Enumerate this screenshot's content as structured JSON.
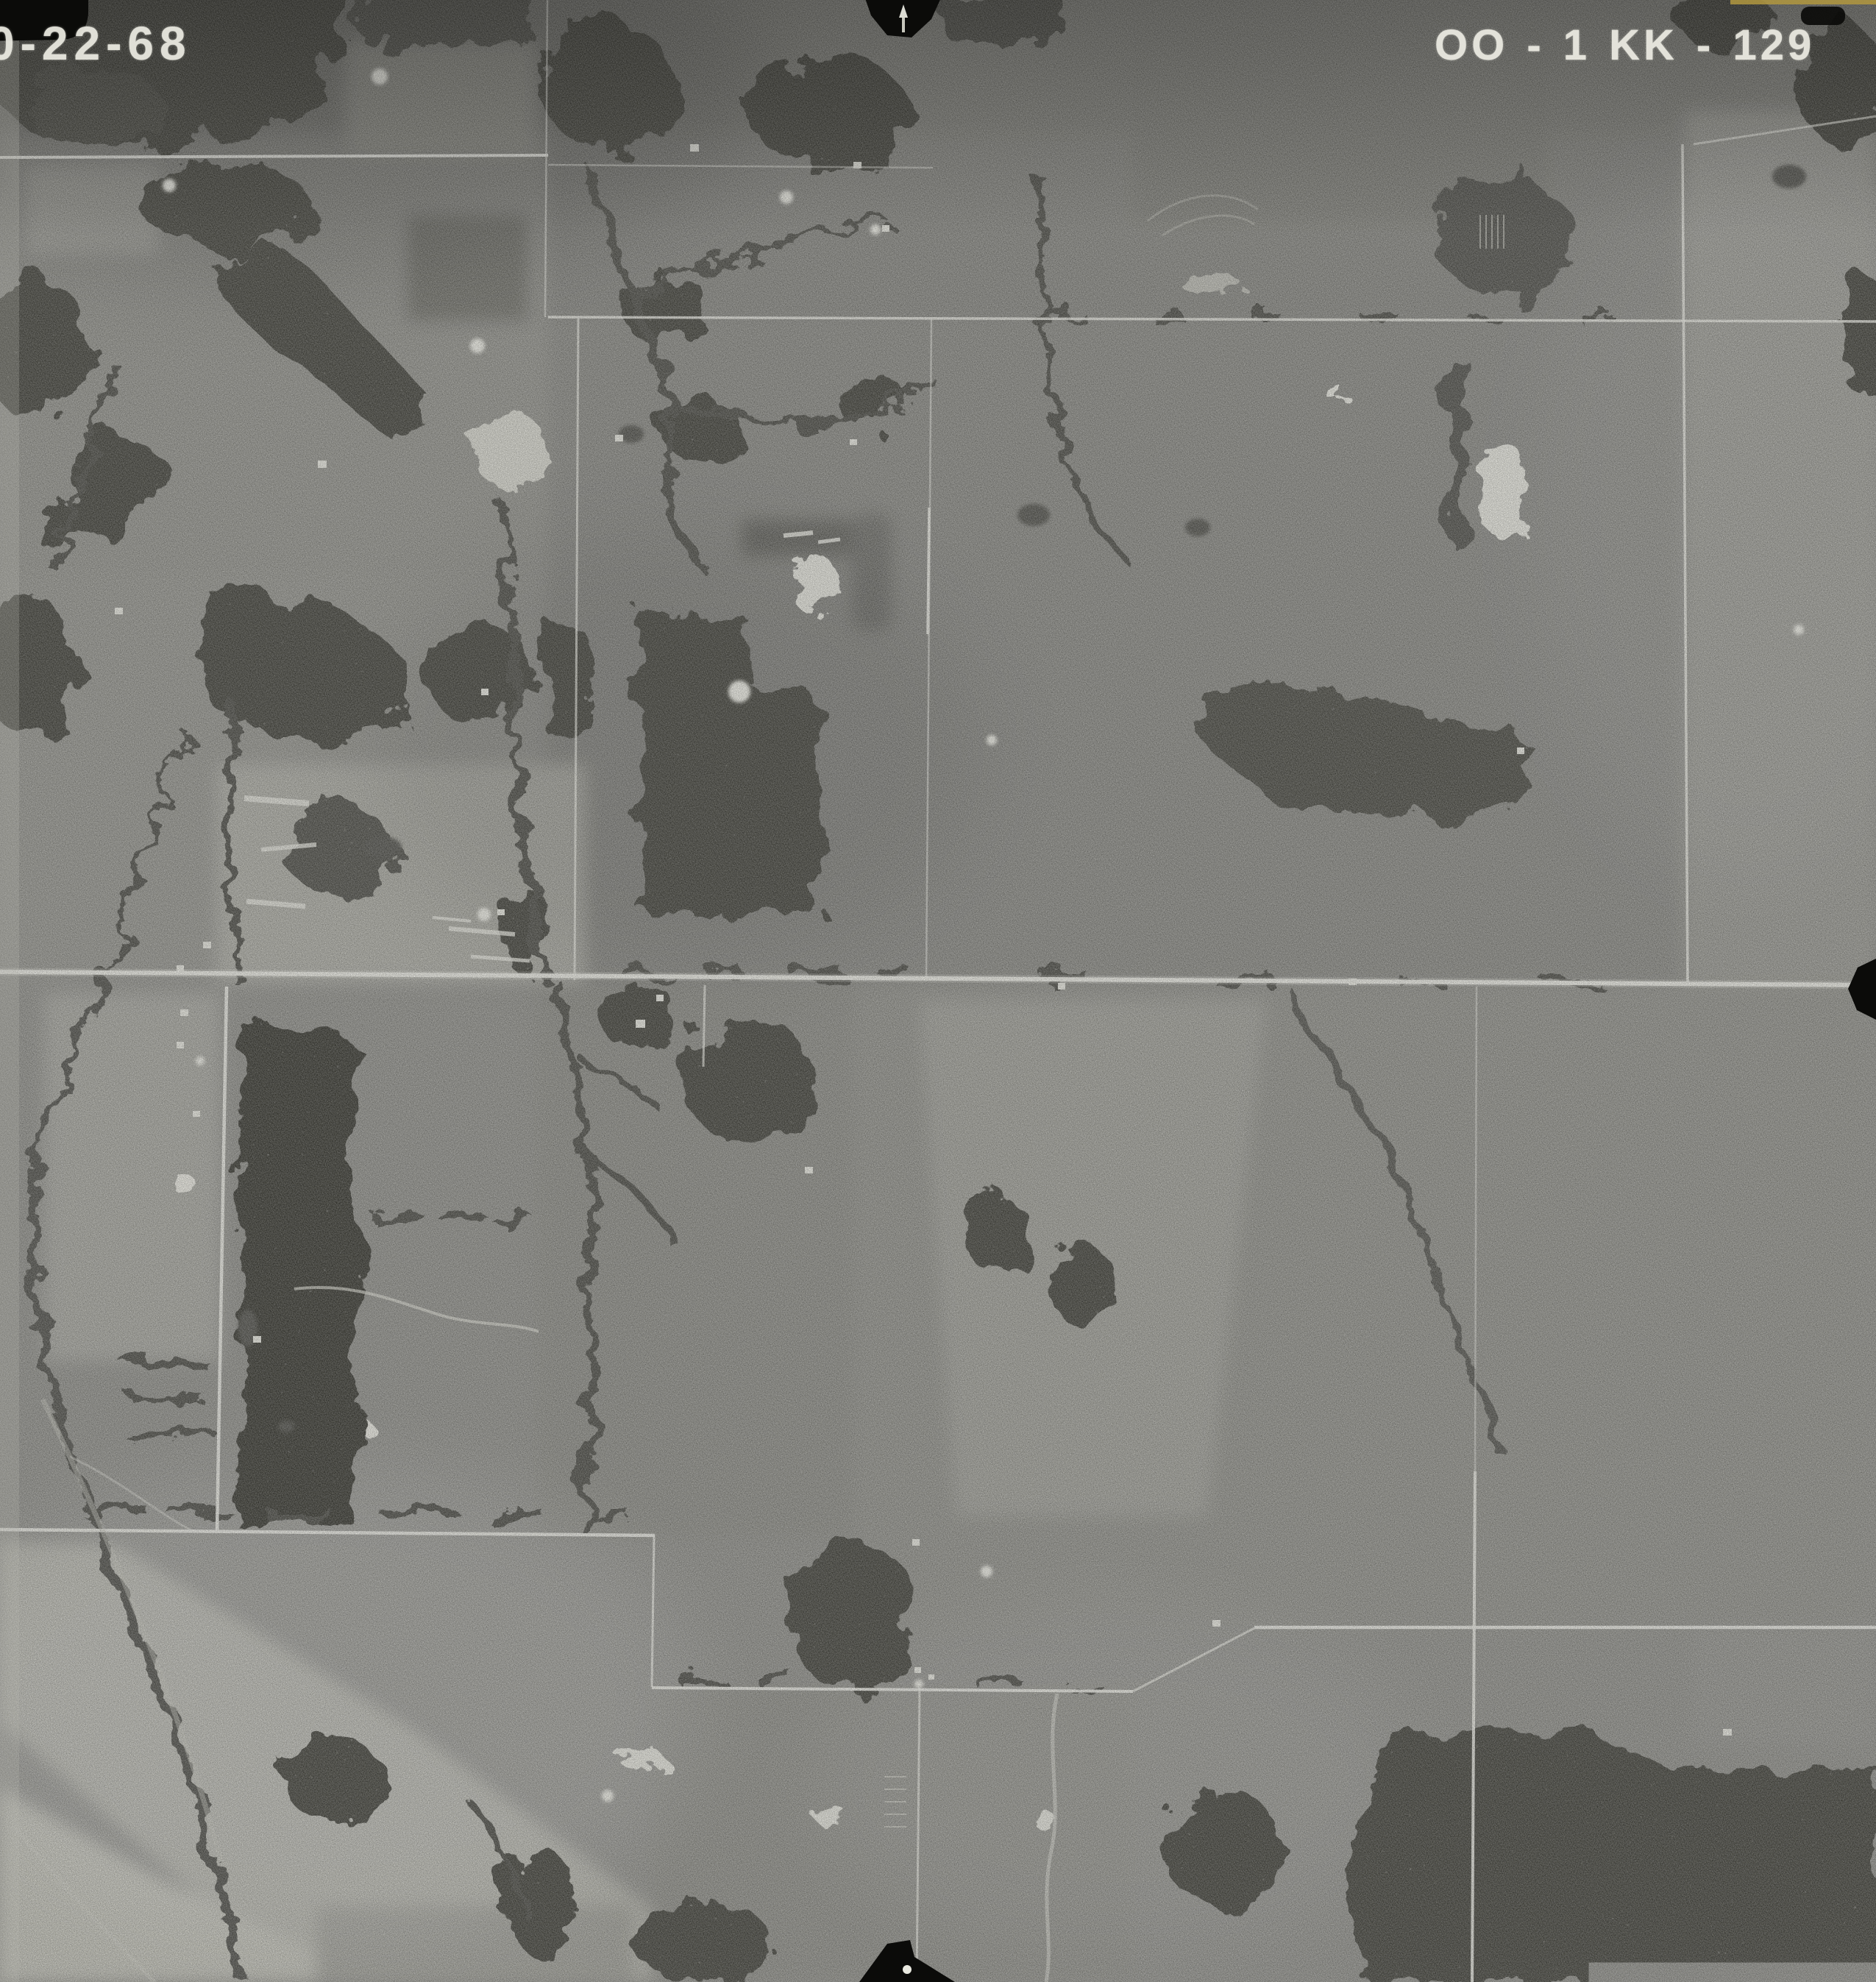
{
  "photo": {
    "date_label": "0-22-68",
    "photo_id": "OO - 1 KK - 129"
  },
  "colors": {
    "terrain_base": "#8c8c86",
    "forest_dark": "#3c3c36",
    "forest_black": "#33302b",
    "creek_dark": "#46463f",
    "road_light": "#e9e9e1",
    "pond_white": "#ecece3",
    "pond_dark": "#4e4e47",
    "farmstead_white": "#e7e7de",
    "fiducial_black": "#0b0b09",
    "film_edge_tan": "#b2983f",
    "label_text": "#edece3"
  },
  "markers": {
    "top_center": "top-center-fiducial-notch",
    "bottom_center": "bottom-center-fiducial-notch",
    "right_edge": "right-edge-fiducial-notch",
    "top_left": "top-left-corner-film-mark",
    "top_right": "top-right-film-mark"
  }
}
